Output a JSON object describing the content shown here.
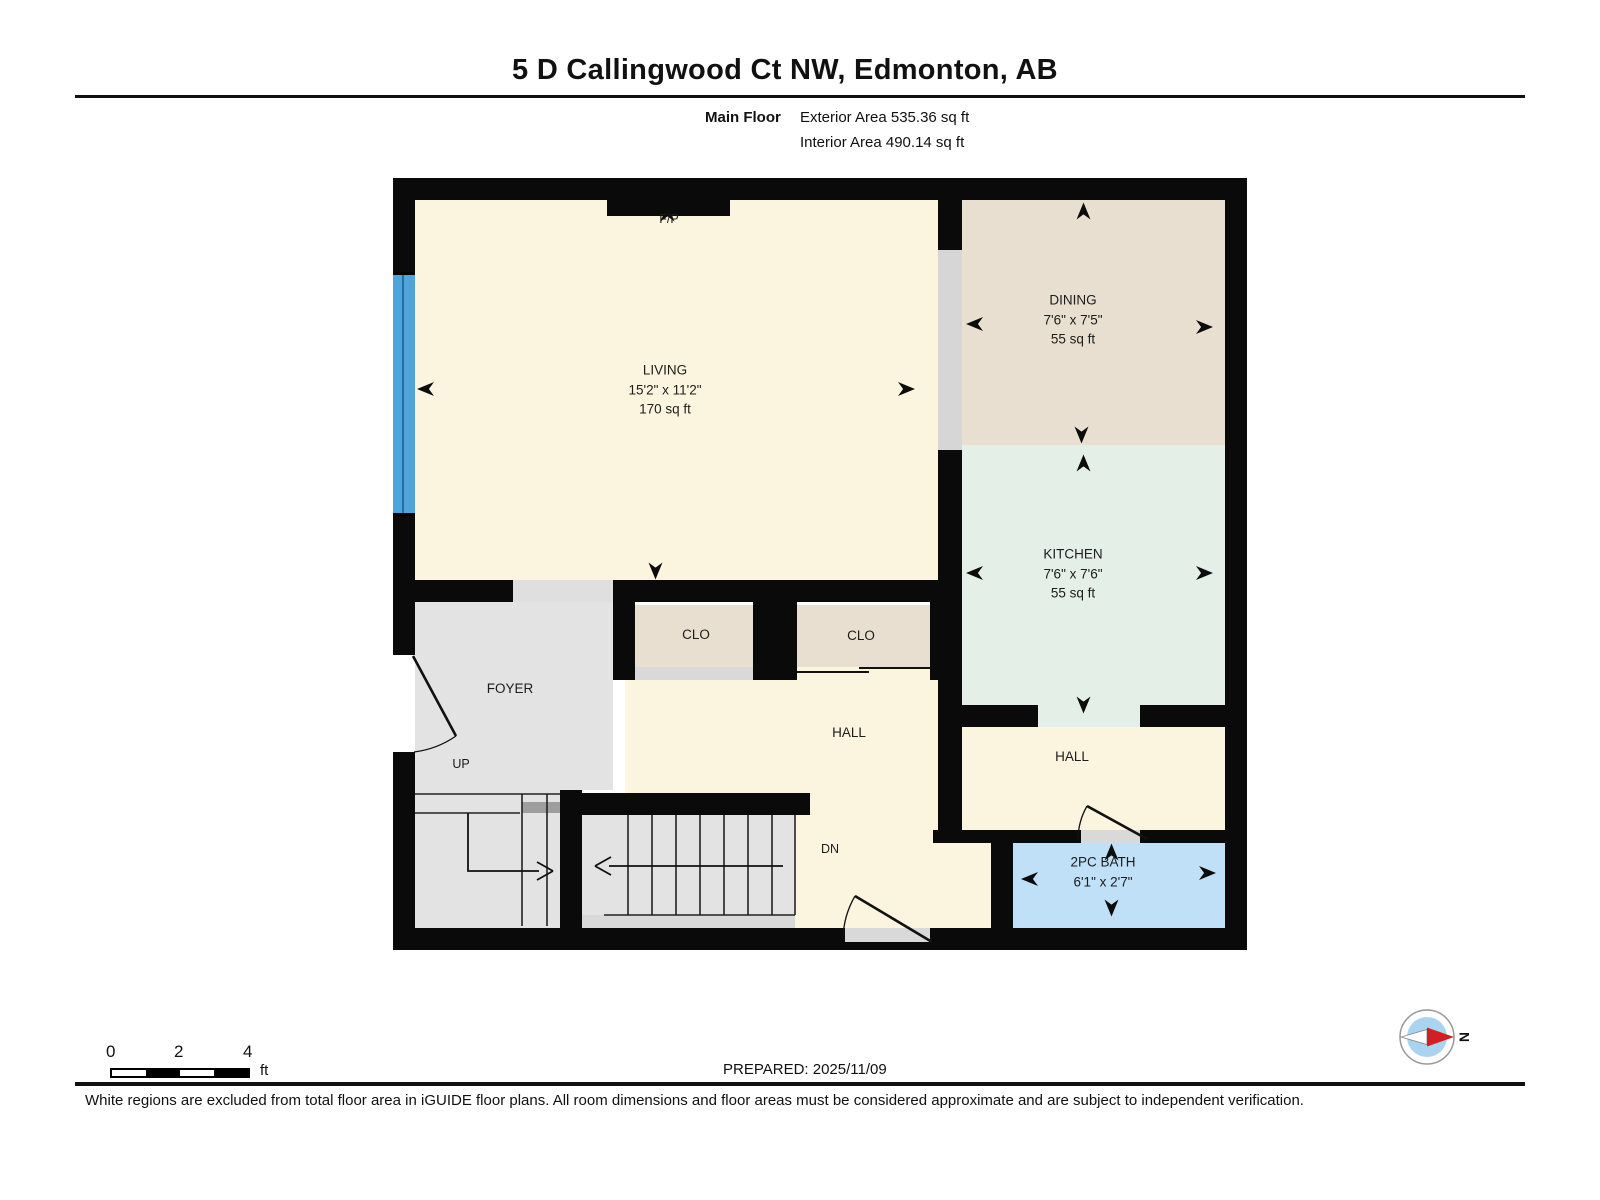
{
  "header": {
    "title": "5 D Callingwood Ct NW, Edmonton, AB",
    "floor_label": "Main Floor",
    "exterior_area": "Exterior Area 535.36 sq ft",
    "interior_area": "Interior Area 490.14 sq ft"
  },
  "plan": {
    "rooms": {
      "living": {
        "name": "LIVING",
        "dims": "15'2\" x 11'2\"",
        "area": "170 sq ft"
      },
      "dining": {
        "name": "DINING",
        "dims": "7'6\" x 7'5\"",
        "area": "55 sq ft"
      },
      "kitchen": {
        "name": "KITCHEN",
        "dims": "7'6\" x 7'6\"",
        "area": "55 sq ft"
      },
      "bath": {
        "name": "2PC BATH",
        "dims": "6'1\" x 2'7\""
      },
      "foyer": {
        "name": "FOYER"
      },
      "hall_center": {
        "name": "HALL"
      },
      "hall_right": {
        "name": "HALL"
      },
      "closet1": {
        "name": "CLO"
      },
      "closet2": {
        "name": "CLO"
      },
      "fireplace": {
        "name": "F/P"
      },
      "stairs_up": {
        "name": "UP"
      },
      "stairs_down": {
        "name": "DN"
      }
    }
  },
  "scale_bar": {
    "ticks": [
      "0",
      "2",
      "4"
    ],
    "unit": "ft"
  },
  "compass": {
    "north_label": "N"
  },
  "footer": {
    "prepared": "PREPARED: 2025/11/09",
    "disclaimer": "White regions are excluded from total floor area in iGUIDE floor plans. All room dimensions and floor areas must be considered approximate and are subject to independent verification."
  },
  "colors": {
    "wall": "#0a0a0a",
    "living_cream": "#FBF5E0",
    "dining_beige": "#E8DFD0",
    "kitchen_mint": "#E4EFE8",
    "bath_blue": "#BFE0F7",
    "foyer_grey": "#E3E3E3",
    "window_blue": "#4FA5DA",
    "compass_blue": "#A9D4F0",
    "compass_red": "#D21F1F"
  }
}
